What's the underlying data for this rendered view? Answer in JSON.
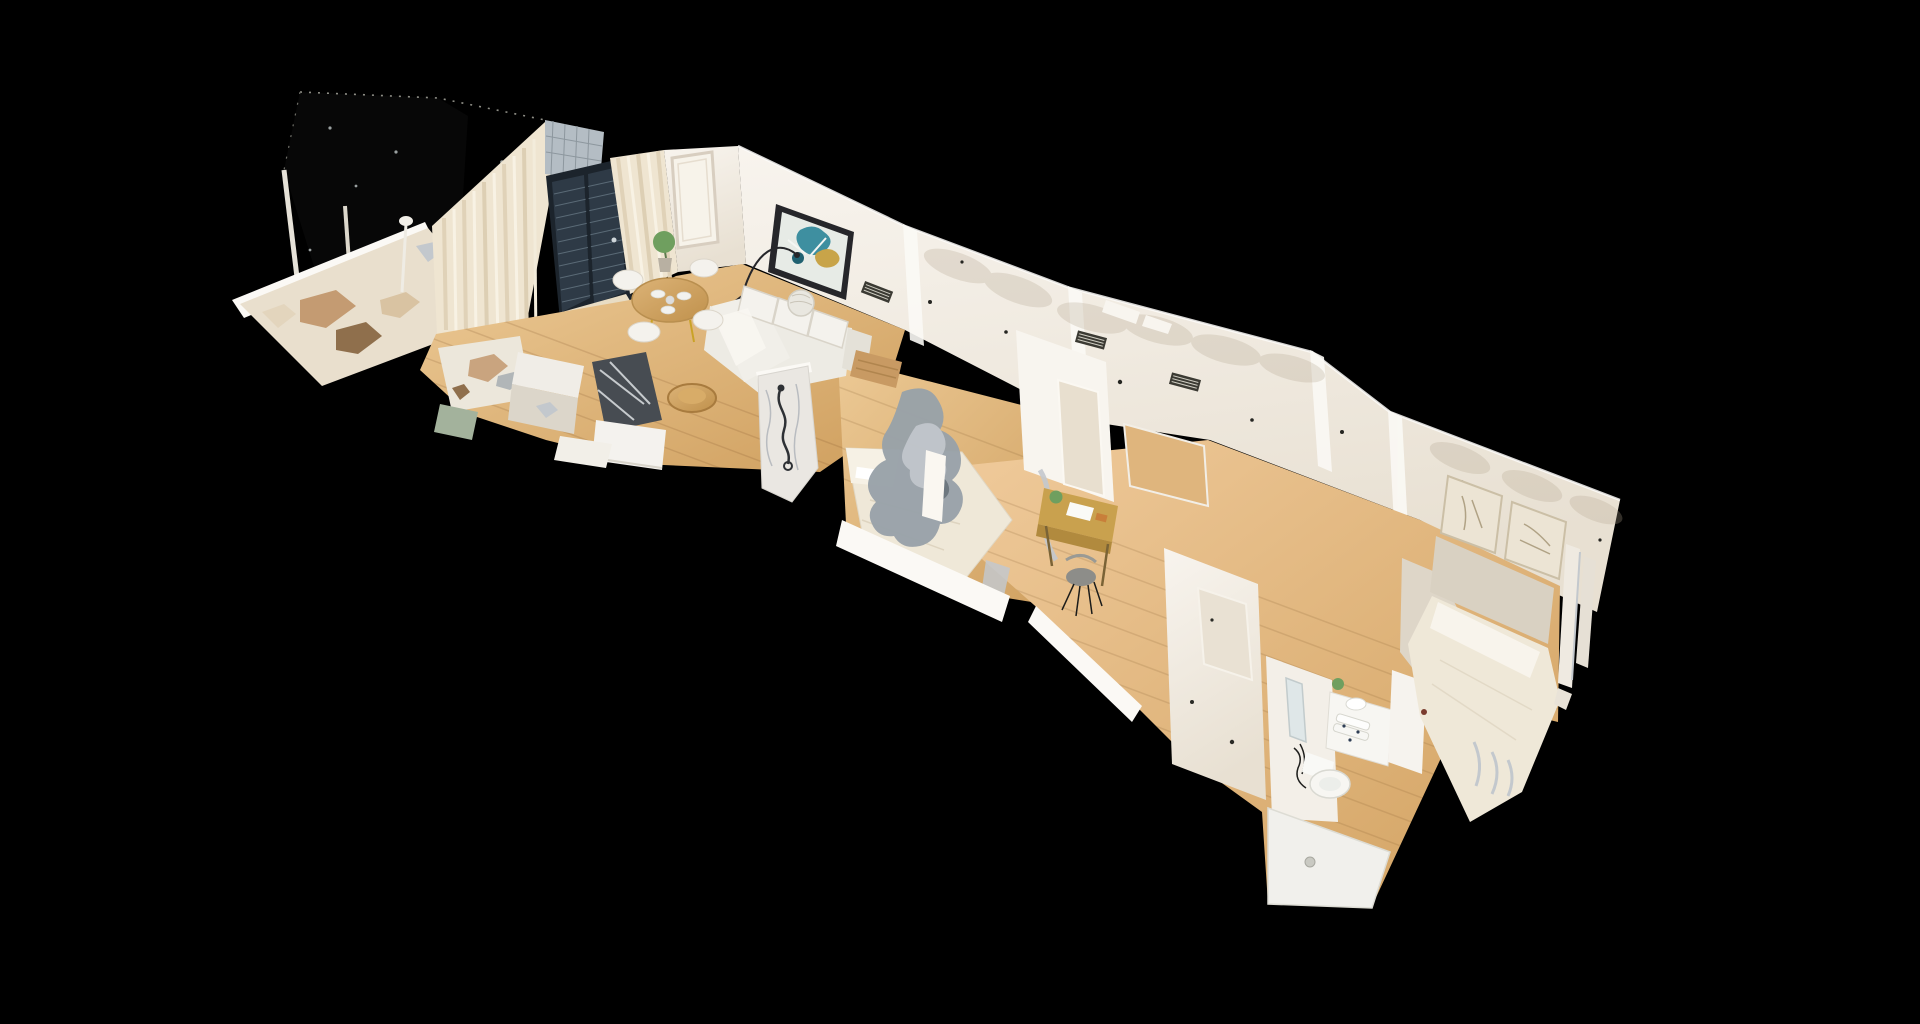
{
  "viewer": {
    "background": "#000000"
  },
  "scene": {
    "rooms": [
      {
        "id": "balcony",
        "label": "balcony-terrace",
        "objects": [
          "dark-unscanned-panel",
          "railing-posts",
          "partial-floor-scan"
        ]
      },
      {
        "id": "living",
        "label": "living-dining-room",
        "objects": [
          "curtains",
          "sliding-glass-door",
          "mosquito-mesh",
          "round-dining-table",
          "dining-chairs",
          "house-plant",
          "arc-floor-lamp",
          "corner-sofa",
          "wall-art",
          "empty-frame",
          "tv",
          "tv-sideboard",
          "coffee-table",
          "wood-bench",
          "floor-lamp"
        ]
      },
      {
        "id": "kitchen",
        "label": "kitchen",
        "objects": [
          "island-counter",
          "cabinets",
          "scan-noise"
        ]
      },
      {
        "id": "shower1",
        "label": "shower-bathroom",
        "objects": [
          "marble-shower-column",
          "hand-shower"
        ]
      },
      {
        "id": "bedroom1",
        "label": "bedroom-1",
        "objects": [
          "double-bed",
          "wall-vents",
          "scan-artifact-blob",
          "doorways"
        ]
      },
      {
        "id": "hallway",
        "label": "hallway",
        "objects": [
          "desk",
          "desk-chair",
          "divider-wall",
          "wall-opening"
        ]
      },
      {
        "id": "bathroom2",
        "label": "bathroom-2",
        "objects": [
          "vanity-sink",
          "towels",
          "toilet",
          "mirror",
          "shower-tray",
          "drain"
        ]
      },
      {
        "id": "bedroom2",
        "label": "bedroom-2",
        "objects": [
          "double-bed",
          "headboard-panel",
          "framed-prints",
          "door-frame"
        ]
      }
    ]
  },
  "palette": {
    "background": "#000000",
    "balcony_panel": "#070707",
    "balcony_floor": "#e9dfcd",
    "curtain": "#efe5d1",
    "curtain_shade": "#ddcfb4",
    "mesh_screen": "#b4bdc4",
    "glass_door": "#2e3a46",
    "glass_frame": "#1c242c",
    "wall": "#f4efe6",
    "wall_shade": "#e7dfd2",
    "wall_bright": "#fbf9f5",
    "art_frame": "#26262a",
    "art_teal": "#3e8fa0",
    "art_gold": "#c8a449",
    "art_navy": "#206171",
    "sofa": "#edebe4",
    "table_wood": "#cda25e",
    "desk_wood": "#c9a14e",
    "plant_green": "#6f9f5f",
    "tv_dark": "#474c52",
    "bed_linen": "#efe8d8",
    "headboard": "#d9d1c2",
    "noise_gray": "#98a1a9",
    "noise_silver": "#c3c8cd",
    "noise_tan": "#c09468",
    "noise_brown": "#8f6f4c",
    "marble": "#eae7e2",
    "fixture_white": "#f7f6f2",
    "vent_dark": "#3b3a33",
    "floor_wood_mid": "#d9ae74"
  }
}
